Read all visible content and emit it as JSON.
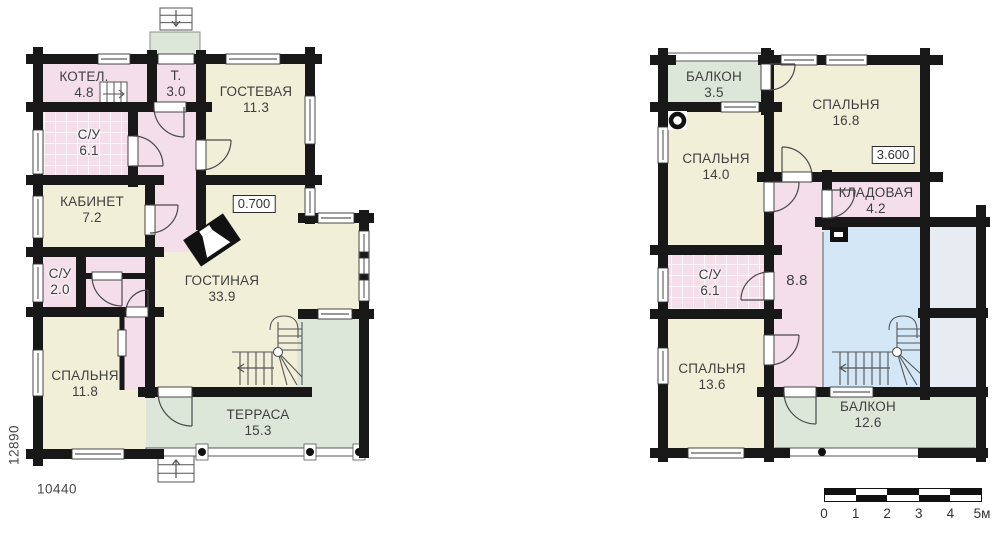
{
  "floor1": {
    "rooms": [
      {
        "name": "КОТЕЛ.",
        "area": "4.8"
      },
      {
        "name": "Т.",
        "area": "3.0"
      },
      {
        "name": "ГОСТЕВАЯ",
        "area": "11.3"
      },
      {
        "name": "С/У",
        "area": "6.1"
      },
      {
        "name": "КАБИНЕТ",
        "area": "7.2"
      },
      {
        "name": "ГОСТИНАЯ",
        "area": "33.9"
      },
      {
        "name": "С/У",
        "area": "2.0"
      },
      {
        "name": "СПАЛЬНЯ",
        "area": "11.8"
      },
      {
        "name": "ТЕРРАСА",
        "area": "15.3"
      }
    ],
    "level_mark": "0.700",
    "dim_vertical": "12890",
    "dim_horizontal": "10440"
  },
  "floor2": {
    "rooms": [
      {
        "name": "БАЛКОН",
        "area": "3.5"
      },
      {
        "name": "СПАЛЬНЯ",
        "area": "16.8"
      },
      {
        "name": "СПАЛЬНЯ",
        "area": "14.0"
      },
      {
        "name": "КЛАДОВАЯ",
        "area": "4.2"
      },
      {
        "name": "С/У",
        "area": "6.1"
      },
      {
        "name": "",
        "area": "8.8"
      },
      {
        "name": "СПАЛЬНЯ",
        "area": "13.6"
      },
      {
        "name": "БАЛКОН",
        "area": "12.6"
      }
    ],
    "level_mark": "3.600"
  },
  "scale_bar": {
    "labels": [
      "0",
      "1",
      "2",
      "3",
      "4",
      "5м"
    ]
  },
  "colors": {
    "room": "#f2efd9",
    "wet": "#f4dee9",
    "outdoor": "#dde7d9",
    "stair": "#d3e7f6",
    "roof": "#e6ecf1",
    "wall": "#181818",
    "text": "#3f3f3f"
  }
}
